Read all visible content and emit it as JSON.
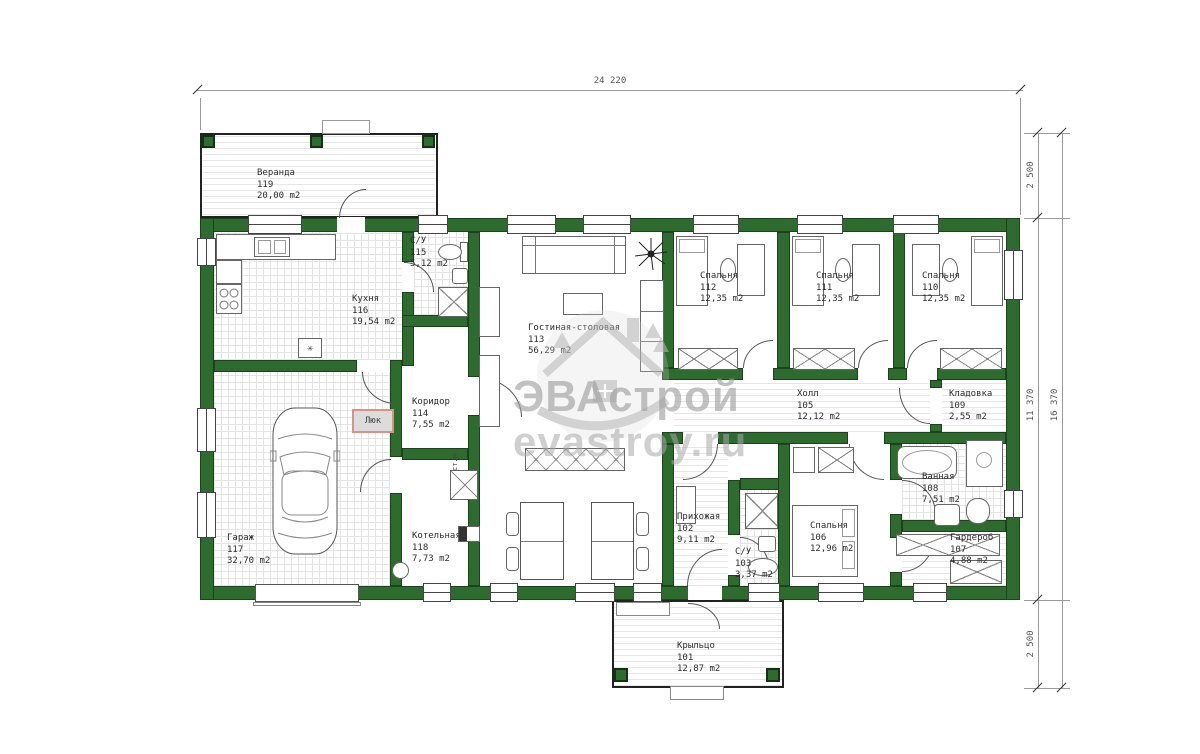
{
  "dimensions": {
    "total_width": "24 220",
    "veranda_depth": "2 500",
    "house_depth": "11 370",
    "porch_depth": "2 500",
    "total_depth": "16 370"
  },
  "watermark": {
    "brand": "ЭВАстрой",
    "site": "evastroy.ru"
  },
  "annotations": {
    "hatch": "Люк",
    "washing_machine": "ст.м",
    "drain": "✳"
  },
  "rooms": {
    "veranda": {
      "name": "Веранда",
      "id": "119",
      "area": "20,00 m2"
    },
    "kitchen": {
      "name": "Кухня",
      "id": "116",
      "area": "19,54 m2"
    },
    "wc1": {
      "name": "С/У",
      "id": "115",
      "area": "5,12 m2"
    },
    "living": {
      "name": "Гостиная-столовая",
      "id": "113",
      "area": "56,29 m2"
    },
    "bedroom112": {
      "name": "Спальня",
      "id": "112",
      "area": "12,35 m2"
    },
    "bedroom111": {
      "name": "Спальня",
      "id": "111",
      "area": "12,35 m2"
    },
    "bedroom110": {
      "name": "Спальня",
      "id": "110",
      "area": "12,35 m2"
    },
    "hall": {
      "name": "Холл",
      "id": "105",
      "area": "12,12 m2"
    },
    "storage": {
      "name": "Кладовка",
      "id": "109",
      "area": "2,55 m2"
    },
    "corridor": {
      "name": "Коридор",
      "id": "114",
      "area": "7,55 m2"
    },
    "garage": {
      "name": "Гараж",
      "id": "117",
      "area": "32,70 m2"
    },
    "boiler": {
      "name": "Котельная",
      "id": "118",
      "area": "7,73 m2"
    },
    "entry": {
      "name": "Прихожая",
      "id": "102",
      "area": "9,11 m2"
    },
    "wc2": {
      "name": "С/У",
      "id": "103",
      "area": "3,37 m2"
    },
    "bedroom106": {
      "name": "Спальня",
      "id": "106",
      "area": "12,96 m2"
    },
    "bath": {
      "name": "Ванная",
      "id": "108",
      "area": "7,51 m2"
    },
    "wardrobe": {
      "name": "Гардероб",
      "id": "107",
      "area": "4,88 m2"
    },
    "porch": {
      "name": "Крыльцо",
      "id": "101",
      "area": "12,87 m2"
    }
  },
  "colors": {
    "wall": "#2e6b2e",
    "hatch_border": "#dd9186",
    "watermark": "#a0a0a0"
  }
}
